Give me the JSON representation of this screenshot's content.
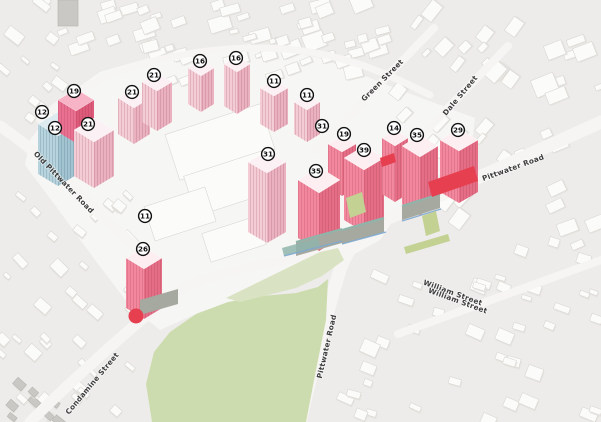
{
  "colors": {
    "map_bg": "#edecea",
    "block_fill": "#fbfbfa",
    "block_edge": "#d9d7d2",
    "road_fill": "#f6f5f3",
    "park_green": "#cddcae",
    "park_green_light": "#d9e3c3",
    "tower_pink": "#f2879d",
    "tower_pink_side": "#e56d86",
    "tower_pink_top": "#fdeef1",
    "tower_pale": "#f4ccd6",
    "tower_pale_side": "#eab2c1",
    "tower_pale_top": "#fbf0f3",
    "tower_rose": "#e97090",
    "tower_rose_side": "#dd5a7b",
    "tower_rose_top": "#f6b4c6",
    "tower_blue": "#b7d4de",
    "tower_blue_side": "#a2c4d1",
    "tower_blue_top": "#ddebf0",
    "podium_grey": "#a6a9a0",
    "podium_teal": "#8fb5ab",
    "accent_red": "#e63f50",
    "marker_bg": "#ffffff",
    "marker_border": "#111111",
    "label_color": "#3d3d3d"
  },
  "markers": [
    {
      "label": "12",
      "x": 42,
      "y": 112
    },
    {
      "label": "12",
      "x": 55,
      "y": 128
    },
    {
      "label": "19",
      "x": 74,
      "y": 91
    },
    {
      "label": "21",
      "x": 88,
      "y": 124
    },
    {
      "label": "21",
      "x": 132,
      "y": 92
    },
    {
      "label": "21",
      "x": 154,
      "y": 75
    },
    {
      "label": "16",
      "x": 200,
      "y": 61
    },
    {
      "label": "16",
      "x": 236,
      "y": 58
    },
    {
      "label": "11",
      "x": 274,
      "y": 81
    },
    {
      "label": "11",
      "x": 307,
      "y": 95
    },
    {
      "label": "31",
      "x": 322,
      "y": 126
    },
    {
      "label": "19",
      "x": 344,
      "y": 134
    },
    {
      "label": "14",
      "x": 394,
      "y": 128
    },
    {
      "label": "35",
      "x": 417,
      "y": 135
    },
    {
      "label": "29",
      "x": 458,
      "y": 130
    },
    {
      "label": "31",
      "x": 268,
      "y": 154
    },
    {
      "label": "35",
      "x": 316,
      "y": 171
    },
    {
      "label": "39",
      "x": 364,
      "y": 150
    },
    {
      "label": "11",
      "x": 145,
      "y": 216
    },
    {
      "label": "26",
      "x": 143,
      "y": 249
    }
  ],
  "streets": [
    {
      "name": "Old Pittwater Road",
      "x": 62,
      "y": 184,
      "angle": 46
    },
    {
      "name": "Green Street",
      "x": 384,
      "y": 82,
      "angle": -45
    },
    {
      "name": "Dale Street",
      "x": 462,
      "y": 97,
      "angle": -50
    },
    {
      "name": "Pittwater Road",
      "x": 514,
      "y": 170,
      "angle": -20
    },
    {
      "name": "Pittwater Road",
      "x": 329,
      "y": 347,
      "angle": -77
    },
    {
      "name": "William Street",
      "x": 452,
      "y": 295,
      "angle": 20
    },
    {
      "name": "William Street",
      "x": 457,
      "y": 303,
      "angle": 20
    },
    {
      "name": "Condamine Street",
      "x": 94,
      "y": 385,
      "angle": -50
    }
  ]
}
